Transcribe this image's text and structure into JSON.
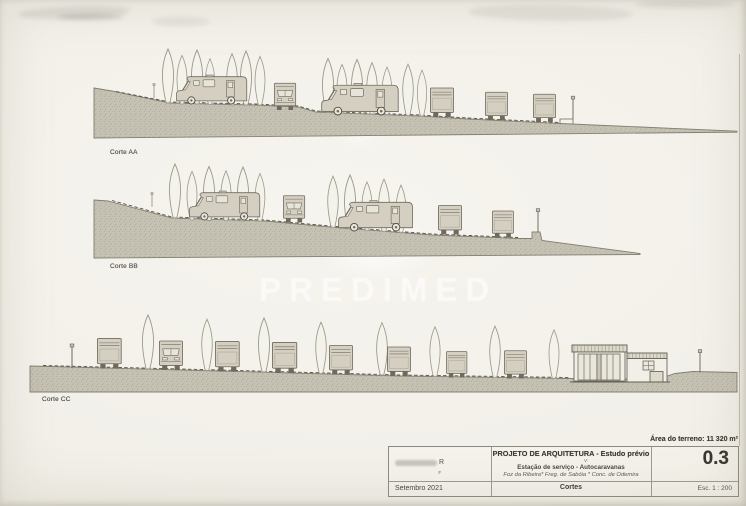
{
  "watermark": {
    "text": "PREDIMED"
  },
  "sections": [
    {
      "label": "Corte AA"
    },
    {
      "label": "Corte BB"
    },
    {
      "label": "Corte CC"
    }
  ],
  "title_block": {
    "area_note": "Área do terreno: 11 320 m²",
    "author_line": "R",
    "author_subline": "F",
    "date": "Setembro 2021",
    "project_title": "PROJETO DE ARQUITETURA - Estudo prévio",
    "version_label": "V:",
    "project_subject": "Estação de serviço - Autocaravanas",
    "project_location": "Foz da Ribeira* Freg. de Sabóia * Conc. de Odemira",
    "drawing_title": "Cortes",
    "sheet_number": "0.3",
    "scale": "Esc. 1 : 200"
  }
}
